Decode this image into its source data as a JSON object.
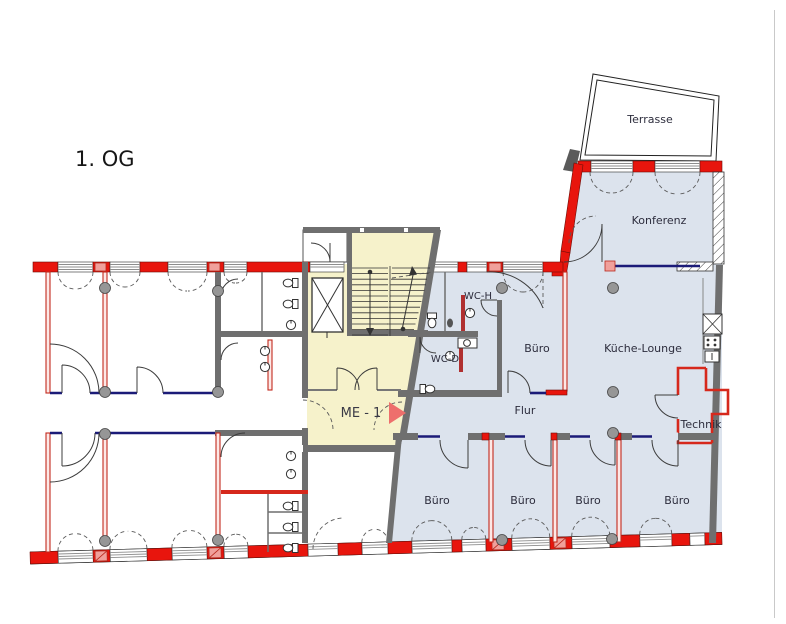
{
  "title": "1. OG",
  "rooms": {
    "terrasse": "Terrasse",
    "konferenz": "Konferenz",
    "kueche_lounge": "Küche-Lounge",
    "buero_top": "Büro",
    "flur": "Flur",
    "technik": "Technik",
    "wc_h": "WC-H",
    "wc_d": "WC-D",
    "me_1": "ME - 1",
    "bueros": [
      "Büro",
      "Büro",
      "Büro",
      "Büro"
    ]
  },
  "marker": {
    "label": "ME - 1",
    "arrow_icon": "right-triangle"
  },
  "colors": {
    "room_fill": "#dce3ed",
    "staircore_fill": "#f6f2cb",
    "new_wall_red": "#e8150d",
    "existing_wall_gray": "#6f6f6f",
    "glass_partition_navy": "#1b1b78",
    "marker_arrow": "#ee6f6c",
    "column_gray": "#969696"
  }
}
